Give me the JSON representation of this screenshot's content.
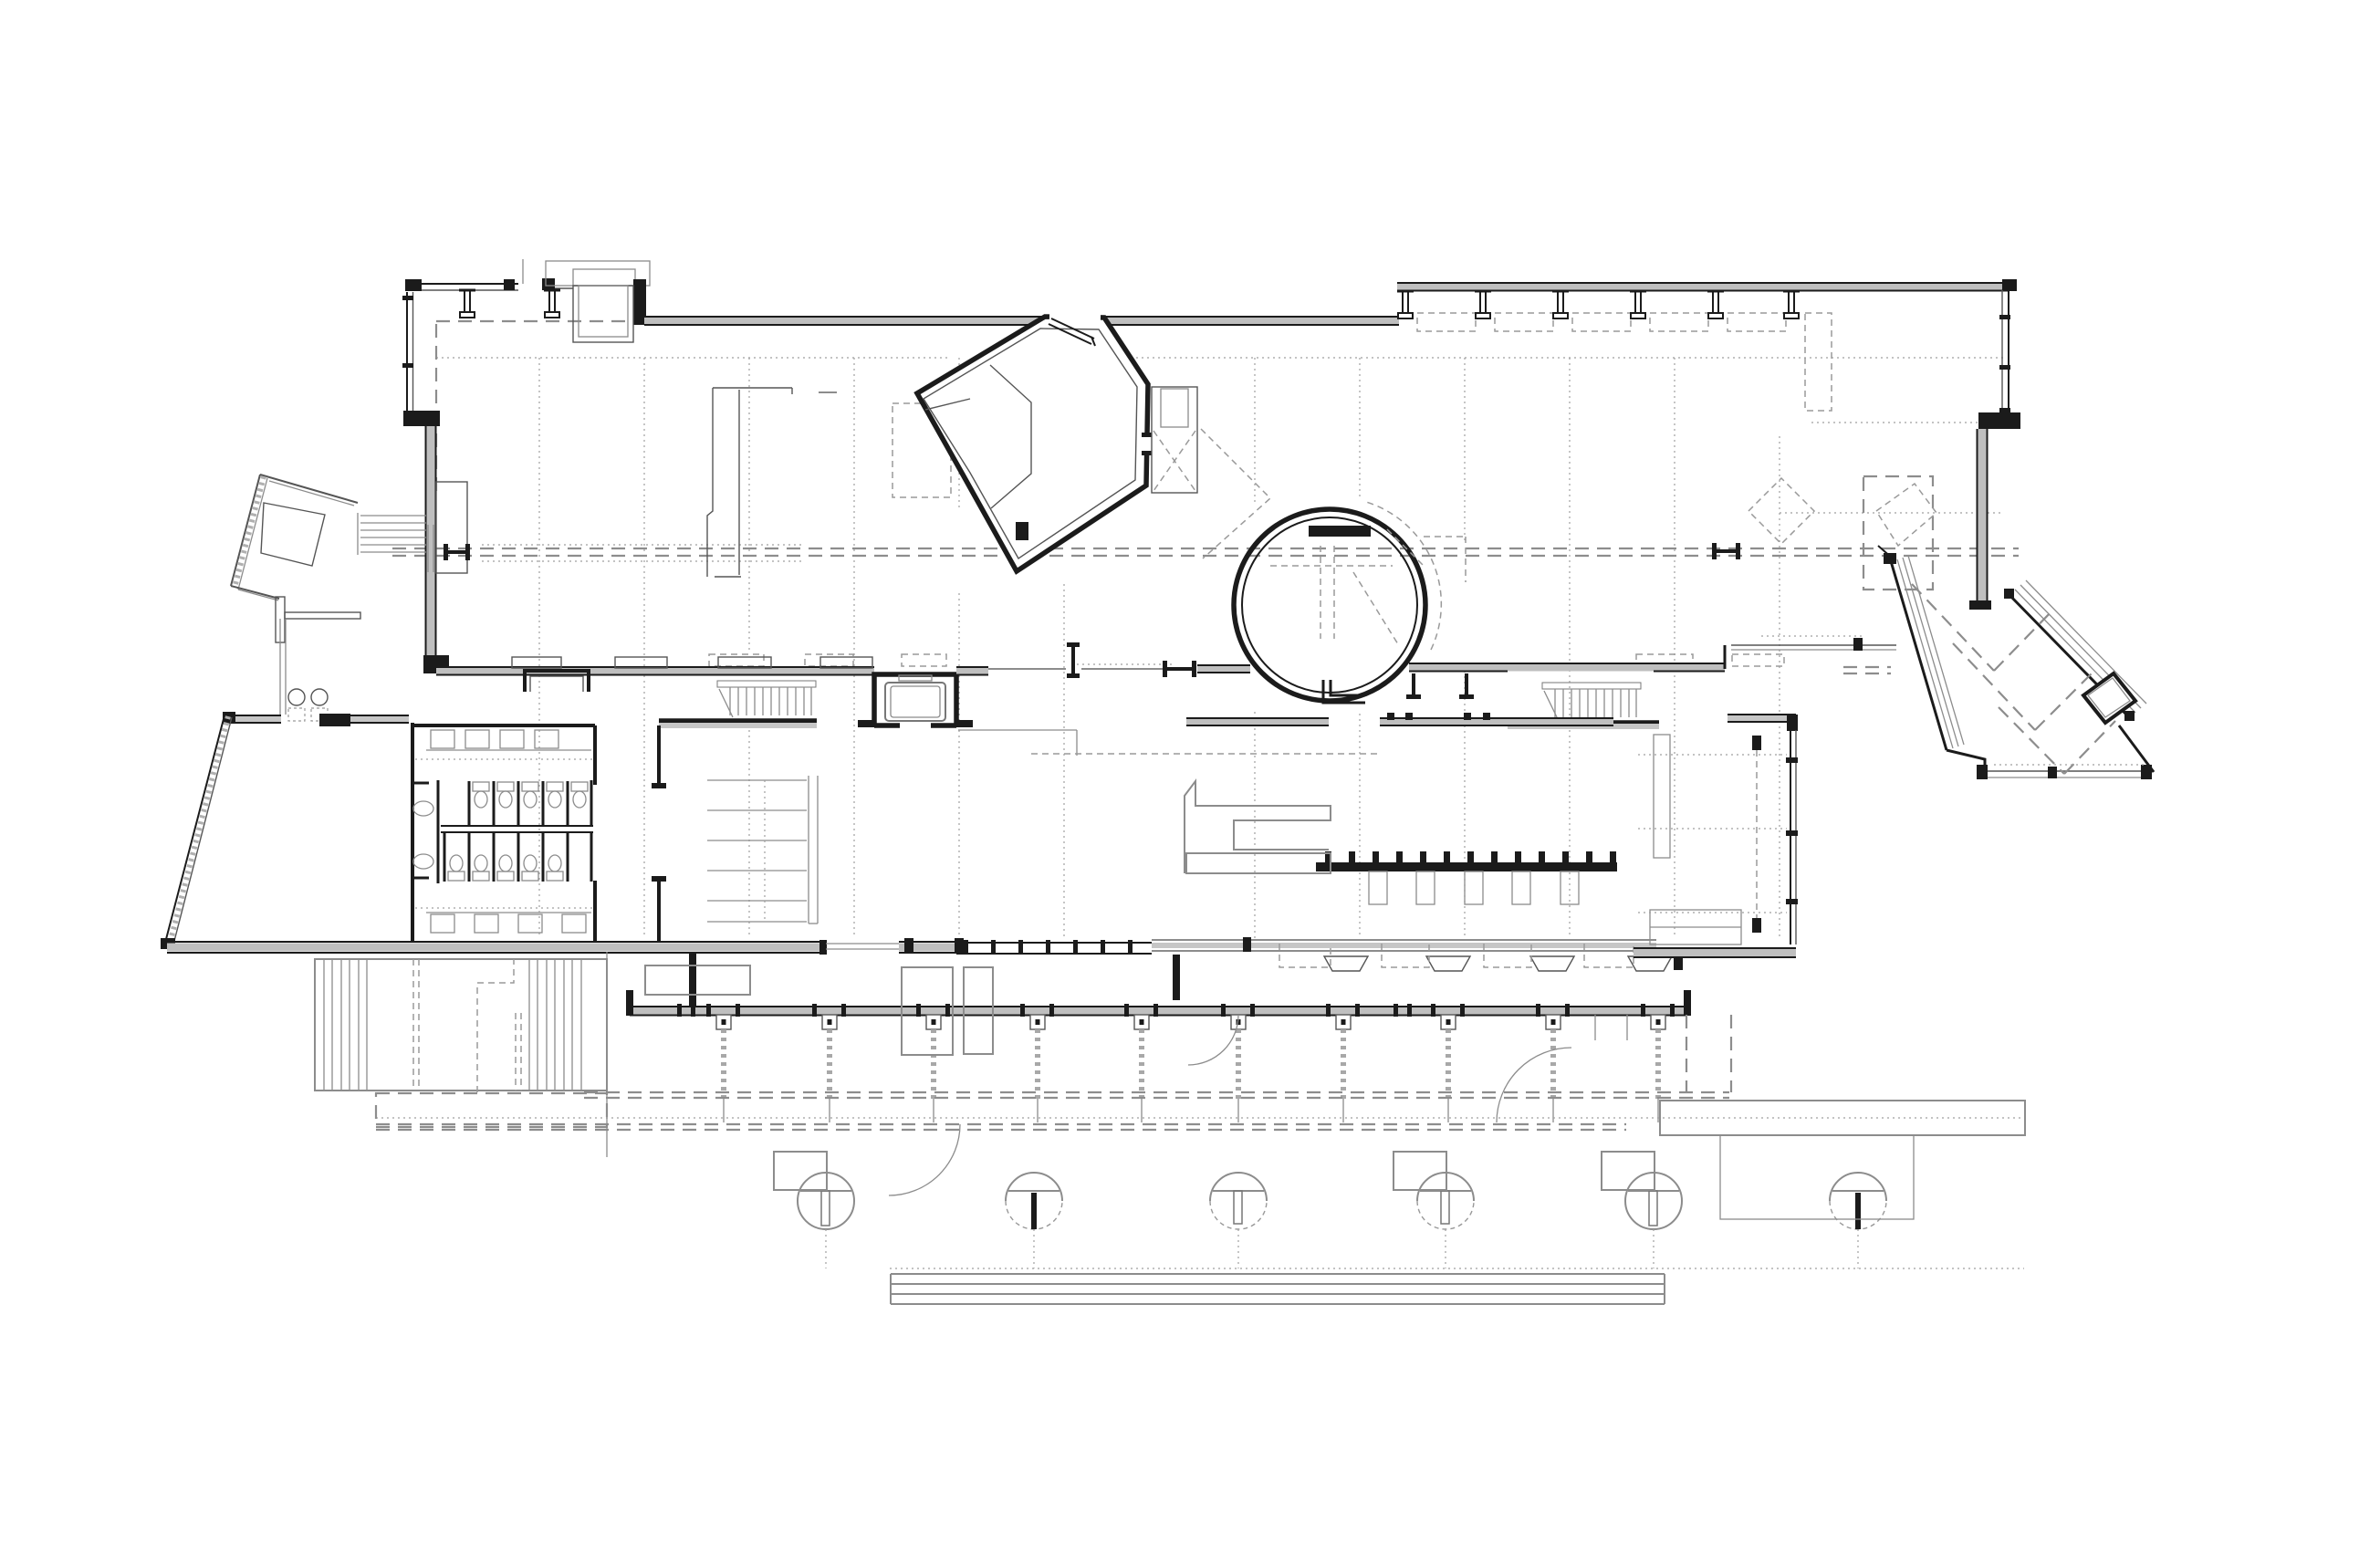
{
  "document": {
    "kind": "architectural floor plan",
    "view": "ground floor plan",
    "style": "black and white CAD line drawing on white sheet",
    "aria_label": "Ground floor plan, black and white architectural line drawing"
  },
  "palette": {
    "background": "#ffffff",
    "ink": "#1b1b1b",
    "wall_gray": "#bfbfbf",
    "line_gray": "#8c8c8c",
    "fixture_gray": "#777777",
    "dash_gray": "#9a9a9a"
  },
  "plan": {
    "wings": [
      {
        "name": "north-gallery",
        "features": [
          "long curtain wall with I-shaped mullions",
          "dotted column grid",
          "dashed roof axis lines"
        ]
      },
      {
        "name": "rotated-gallery-pavilion",
        "features": [
          "five-sided rotated room",
          "open door leaf at top",
          "attached service shaft with dashed diagonals"
        ]
      },
      {
        "name": "circular-room",
        "features": [
          "double-ring wall with four openings",
          "interior dashed roof lines",
          "outer dashed arc"
        ]
      },
      {
        "name": "east-angled-wing",
        "features": [
          "two glazed diagonal walls",
          "rotated square vestibule",
          "dashed roof diagonals"
        ]
      },
      {
        "name": "west-entry-pavilion",
        "features": [
          "tilted square kiosk",
          "exterior stair",
          "hatched ramp wall",
          "two round planters"
        ]
      },
      {
        "name": "southwest-hall",
        "features": [
          "trapezoidal room",
          "restroom block with toilet stalls and vanities"
        ]
      },
      {
        "name": "core",
        "features": [
          "two straight stair runs",
          "elevator cab",
          "wide south stair",
          "freestanding display partition"
        ]
      },
      {
        "name": "south-arcade",
        "features": [
          "mullioned porch wall",
          "hanging tie columns with dashed chains",
          "column capitals",
          "door swing arcs"
        ]
      },
      {
        "name": "terrace",
        "features": [
          "round site columns with T fins",
          "long entry steps",
          "raised platform",
          "west deck stairs"
        ]
      }
    ],
    "counts": {
      "north_mullions": 6,
      "arcade_tie_columns": 10,
      "round_columns": 6,
      "toilet_stalls": 10,
      "stair_runs": 5,
      "column_capitals": 4
    }
  }
}
